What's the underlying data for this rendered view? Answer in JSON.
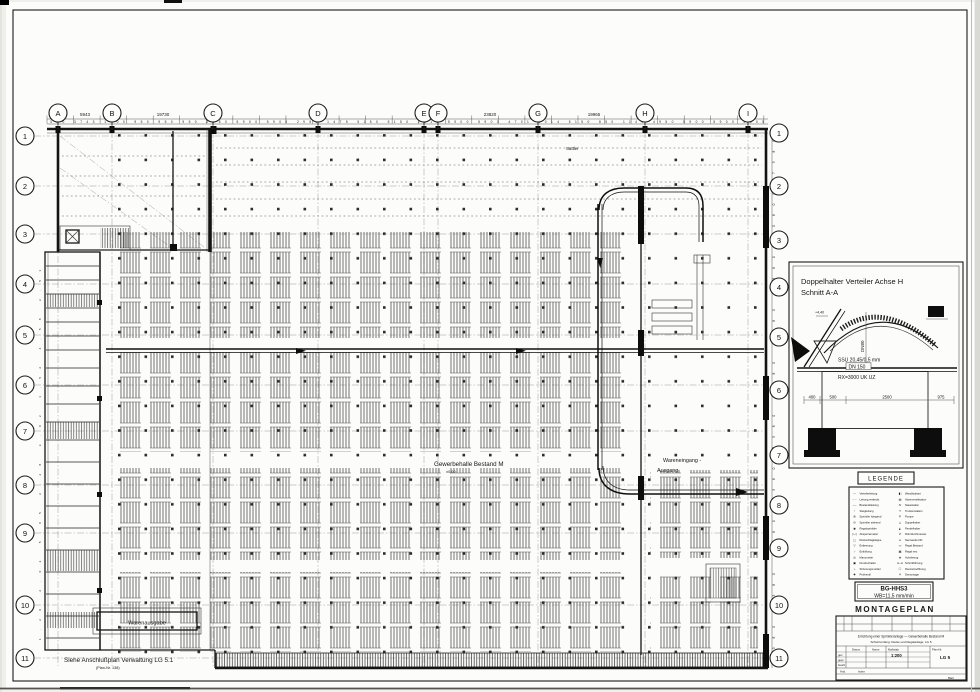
{
  "colors": {
    "ink": "#1a1a1a",
    "paper": "#fcfcfa",
    "background": "#efefec"
  },
  "axes": {
    "cols": [
      "A",
      "B",
      "C",
      "D",
      "E",
      "F",
      "G",
      "H",
      "I"
    ],
    "rows": [
      "1",
      "2",
      "3",
      "4",
      "5",
      "6",
      "7",
      "8",
      "9",
      "10",
      "11"
    ]
  },
  "dims": {
    "top_major_1": "5943",
    "top_major_2": "19730",
    "top_major_3": "23820",
    "top_major_4": "19965",
    "top_minor": "300 3743 1400 950 950 950 2950 5900 5900 2950 1475 5150 5150 1515 5900 5900 4701 2014 5150 850 1149 4950 5900 5900 2505",
    "right_chain": "7380 7380 7380 7380 7380 7380 7380 7380 10800 7380",
    "left_chain": "1,29 2,02 5,05 2,28 3,02 1,52 4,58 2,51"
  },
  "plan": {
    "roof_note": "Sattler",
    "hall_label": "Gewerbehalle Bestand M",
    "hall_sub": "±0,00",
    "wareneingang_1": "Wareneingang -",
    "wareneingang_2": "Ausgang",
    "warenausgabe": "Warenausgabe",
    "footnote": "Siehe Anschlußplan Verwaltung LG 5.1",
    "footnote_sub": "(Plan-Nr. 138)"
  },
  "detail": {
    "title_1": "Doppelhalter Verteiler Achse H",
    "title_2": "Schnitt A-A",
    "label_ssu": "SSU 20,45/0,5 mm",
    "label_dn": "DN 150",
    "label_rx": "RX=3000 UK UZ",
    "label_dn80": "DN80",
    "label_level": "+4,40",
    "label_100": "100",
    "dim_400": "400",
    "dim_500": "500",
    "dim_2500": "2500",
    "dim_975": "975"
  },
  "legend": {
    "title": "LEGENDE",
    "col1": [
      {
        "s": "—",
        "t": "Verteilerleitung"
      },
      {
        "s": "– –",
        "t": "Leitung verdeckt"
      },
      {
        "s": "·—·",
        "t": "Bestandsleitung"
      },
      {
        "s": "↑",
        "t": "Steigleitung"
      },
      {
        "s": "⊕",
        "t": "Sprinkler hängend"
      },
      {
        "s": "⊖",
        "t": "Sprinkler stehend"
      },
      {
        "s": "◉",
        "t": "Regalsprinkler"
      },
      {
        "s": "▷◁",
        "t": "Absperrarmatur"
      },
      {
        "s": "◻",
        "t": "Rückschlagklappe"
      },
      {
        "s": "▽",
        "t": "Entleerung"
      },
      {
        "s": "○",
        "t": "Entlüftung"
      },
      {
        "s": "◎",
        "t": "Manometer"
      },
      {
        "s": "▣",
        "t": "Druckschalter"
      },
      {
        "s": "⌁",
        "t": "Strömungsmelder"
      },
      {
        "s": "✚",
        "t": "Prüfventil"
      }
    ],
    "col2": [
      {
        "s": "◧",
        "t": "Wandhydrant"
      },
      {
        "s": "▤",
        "t": "Alarmventilstation"
      },
      {
        "s": "N",
        "t": "Nassstation"
      },
      {
        "s": "T",
        "t": "Trockenstation"
      },
      {
        "s": "P",
        "t": "Pumpe"
      },
      {
        "s": "◬",
        "t": "Doppelhalter"
      },
      {
        "s": "◭",
        "t": "Pendelhalter"
      },
      {
        "s": "∅",
        "t": "Rohrdurchmesser"
      },
      {
        "s": "⌀",
        "t": "Nennweite DN"
      },
      {
        "s": "▭",
        "t": "Regal Bestand"
      },
      {
        "s": "▦",
        "t": "Regal neu"
      },
      {
        "s": "◈",
        "t": "Achsbezug"
      },
      {
        "s": "A–A",
        "t": "Schnittführung"
      },
      {
        "s": "☐",
        "t": "Revisionsöffnung"
      },
      {
        "s": "✕",
        "t": "Demontage"
      }
    ]
  },
  "stamp": {
    "line1": "BG-HHS3",
    "line2": "WB=11,5 mm/min"
  },
  "plan_title": "MONTAGEPLAN",
  "titleblock": {
    "desc1": "Errichtung einer Sprinkleranlage — Gewerbehalle Bestand M",
    "desc2": "Schutzumfang: Decke und Regalanlage, LG 5",
    "datum": "Datum",
    "name": "Name",
    "gez": "gez.",
    "gepr": "gepr.",
    "bearb": "bearb.",
    "massstab": "Maßstab",
    "scale": "1:200",
    "plannr": "Plan-Nr.",
    "planval": "LG 5",
    "aend": "Änd.",
    "index": "Index",
    "blatt": "Blatt"
  }
}
